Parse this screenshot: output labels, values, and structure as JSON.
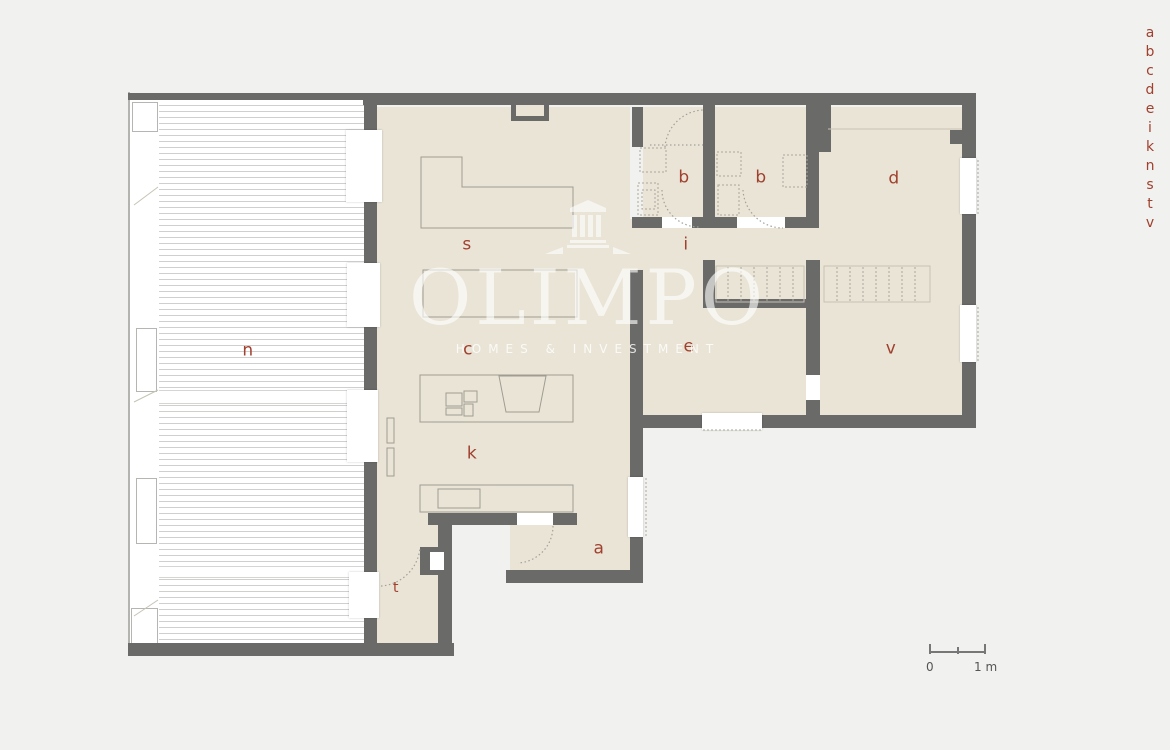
{
  "palette": {
    "background": "#f1f1ef",
    "wall": "#6a6a68",
    "floor": "#e9e4d6",
    "deck_line": "#cfcfcd",
    "label_red": "#a0402e",
    "watermark_white": "rgba(255,255,255,0.62)"
  },
  "rooms": {
    "n": "n",
    "s": "s",
    "c": "c",
    "k": "k",
    "t": "t",
    "a": "a",
    "b1": "b",
    "b2": "b",
    "i": "i",
    "e": "e",
    "d": "d",
    "v": "v"
  },
  "legend": {
    "letters": [
      "a",
      "b",
      "c",
      "d",
      "e",
      "i",
      "k",
      "n",
      "s",
      "t",
      "v"
    ]
  },
  "watermark": {
    "name": "OLIMPO",
    "tagline": "HOMES & INVESTMENT"
  },
  "scale_bar": {
    "zero": "0",
    "one_meter": "1 m"
  }
}
